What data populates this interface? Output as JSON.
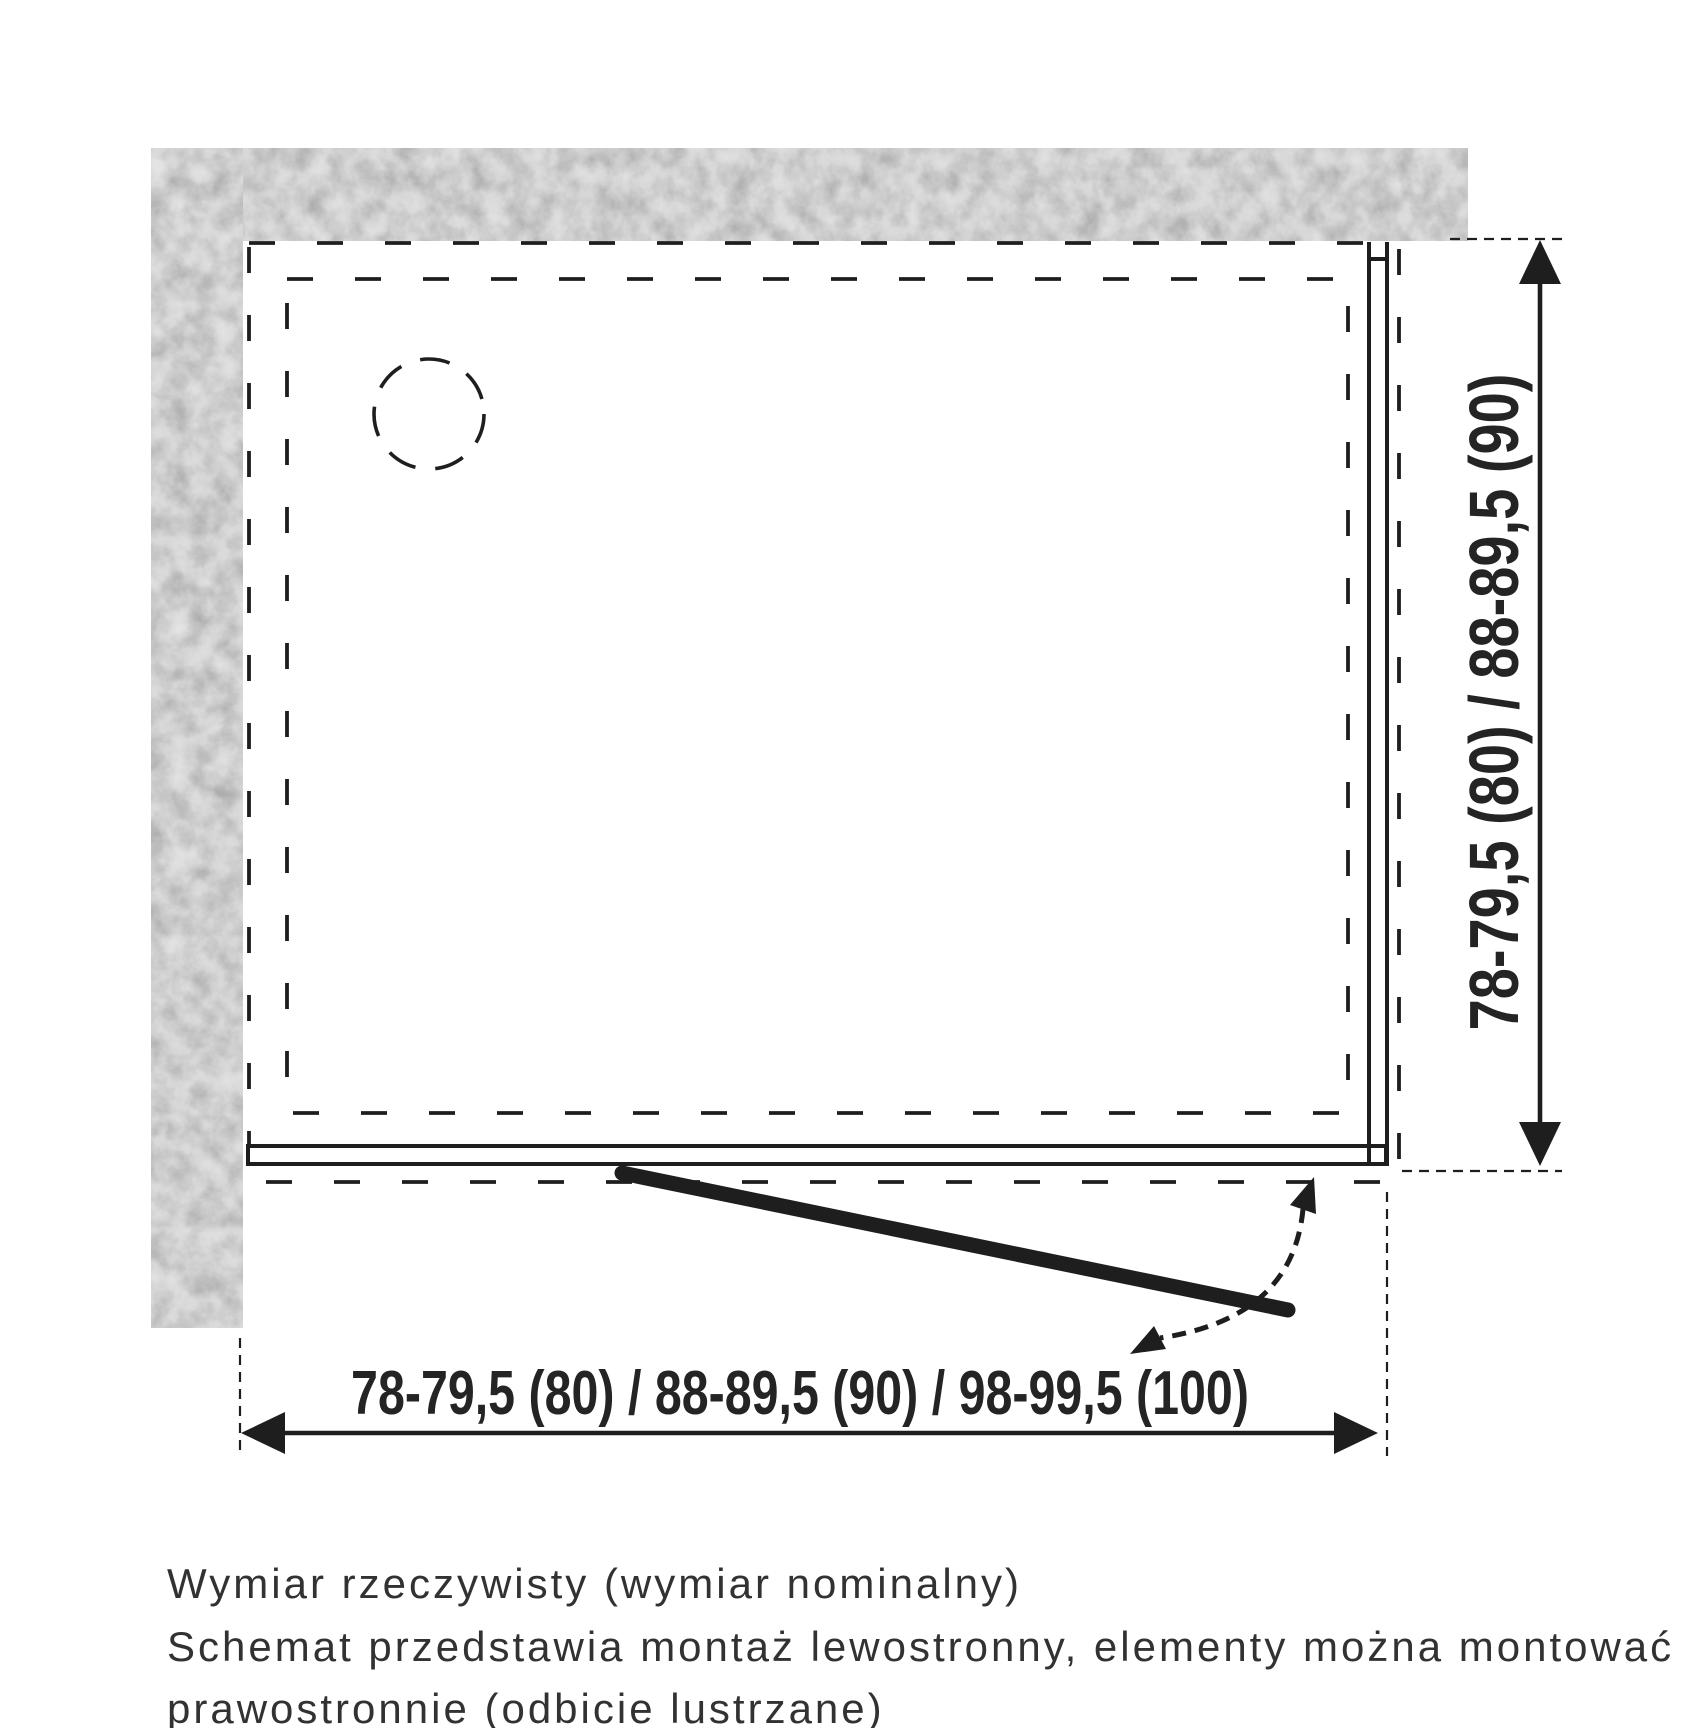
{
  "diagram": {
    "type": "shower-enclosure-installation-plan-top-view",
    "colors": {
      "background": "#ffffff",
      "line": "#1e1e1e",
      "wall_fill": "#e3e3e3",
      "wall_speckle": "#9a9a9a",
      "text": "#323232"
    },
    "width_dimension_label": "78-79,5 (80) / 88-89,5 (90) / 98-99,5 (100)",
    "height_dimension_label": "78-79,5 (80) / 88-89,5 (90)",
    "notes": [
      "Wymiar rzeczywisty (wymiar nominalny)",
      "Schemat przedstawia montaż lewostronny, elementy można montować",
      "prawostronnie (odbicie lustrzane)"
    ]
  }
}
